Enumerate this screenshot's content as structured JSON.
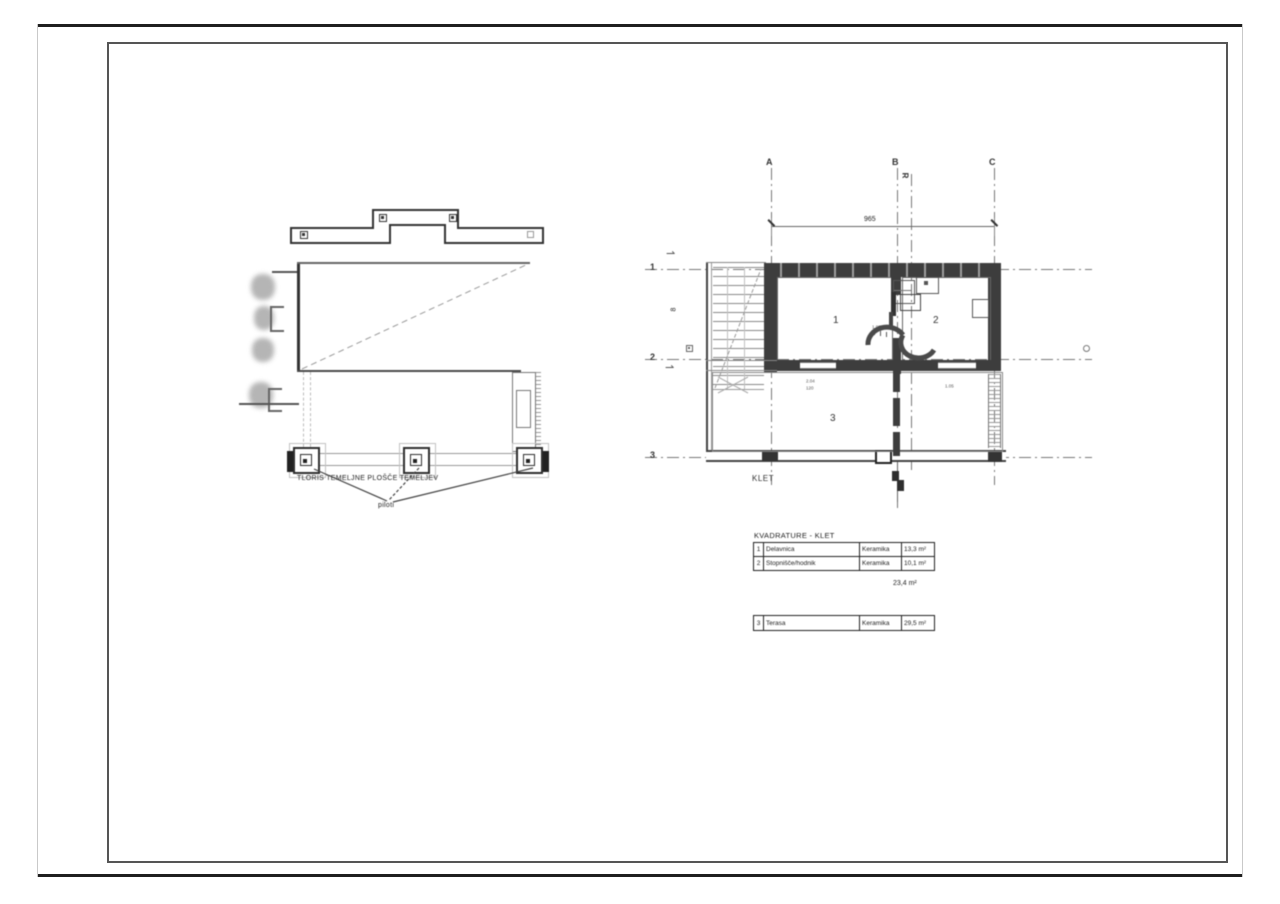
{
  "foundation_plan": {
    "caption": "TLORIS TEMELJNE PLOŠČE TEMELJEV",
    "leader_label": "piloti"
  },
  "floor_plan": {
    "title": "KLET",
    "grid_columns": [
      "A",
      "B",
      "C"
    ],
    "grid_rows": [
      "1",
      "2",
      "3"
    ],
    "aux_axis_label": "R",
    "width_dimension": "965",
    "height_dimension": "8",
    "room_numbers": [
      "1",
      "2",
      "3"
    ],
    "room_tags": {
      "stair": "1.03",
      "left": "2.04",
      "left_sub": "120",
      "right": "1.05"
    }
  },
  "area_table": {
    "title": "KVADRATURE - KLET",
    "rows": [
      {
        "no": "1",
        "name": "Delavnica",
        "finish": "Keramika",
        "area": "13,3 m²"
      },
      {
        "no": "2",
        "name": "Stopnišče/hodnik",
        "finish": "Keramika",
        "area": "10,1 m²"
      }
    ],
    "total": "23,4 m²"
  },
  "terrace_table": {
    "rows": [
      {
        "no": "3",
        "name": "Terasa",
        "finish": "Keramika",
        "area": "29,5 m²"
      }
    ]
  }
}
